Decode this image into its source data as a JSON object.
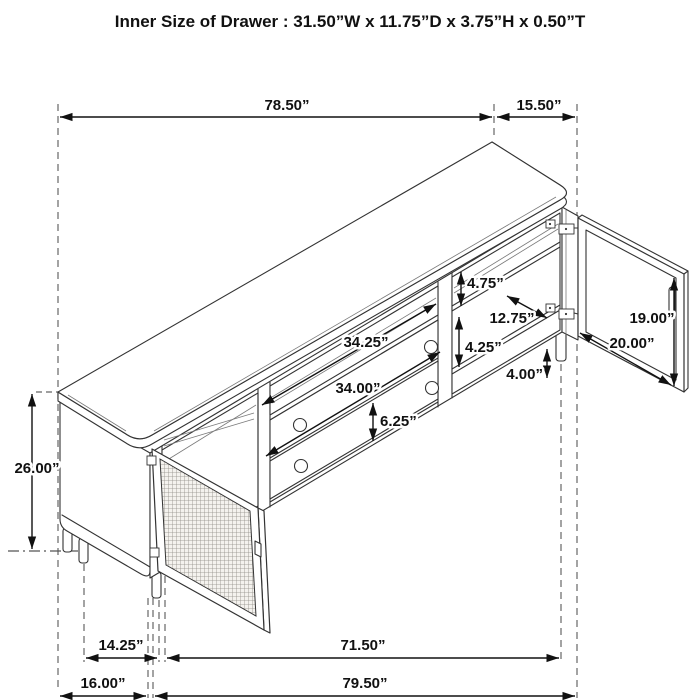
{
  "title": "Inner Size of Drawer : 31.50”W x 11.75”D x 3.75”H x 0.50”T",
  "dims": {
    "top_length": "78.50”",
    "top_depth": "15.50”",
    "overall_height": "26.00”",
    "upper_gap_height": "4.75”",
    "shelf_depth": "12.75”",
    "opening_width": "34.25”",
    "lower_gap_height": "4.25”",
    "door_height": "19.00”",
    "door_width": "20.00”",
    "drawer_width": "34.00”",
    "leg_height": "4.00”",
    "drawer_height": "6.25”",
    "base_inset_left": "14.25”",
    "base_front_span": "71.50”",
    "side_depth": "16.00”",
    "overall_width": "79.50”"
  },
  "colors": {
    "line": "#333333",
    "dimension": "#111111",
    "extension": "#666666",
    "background": "#ffffff"
  }
}
